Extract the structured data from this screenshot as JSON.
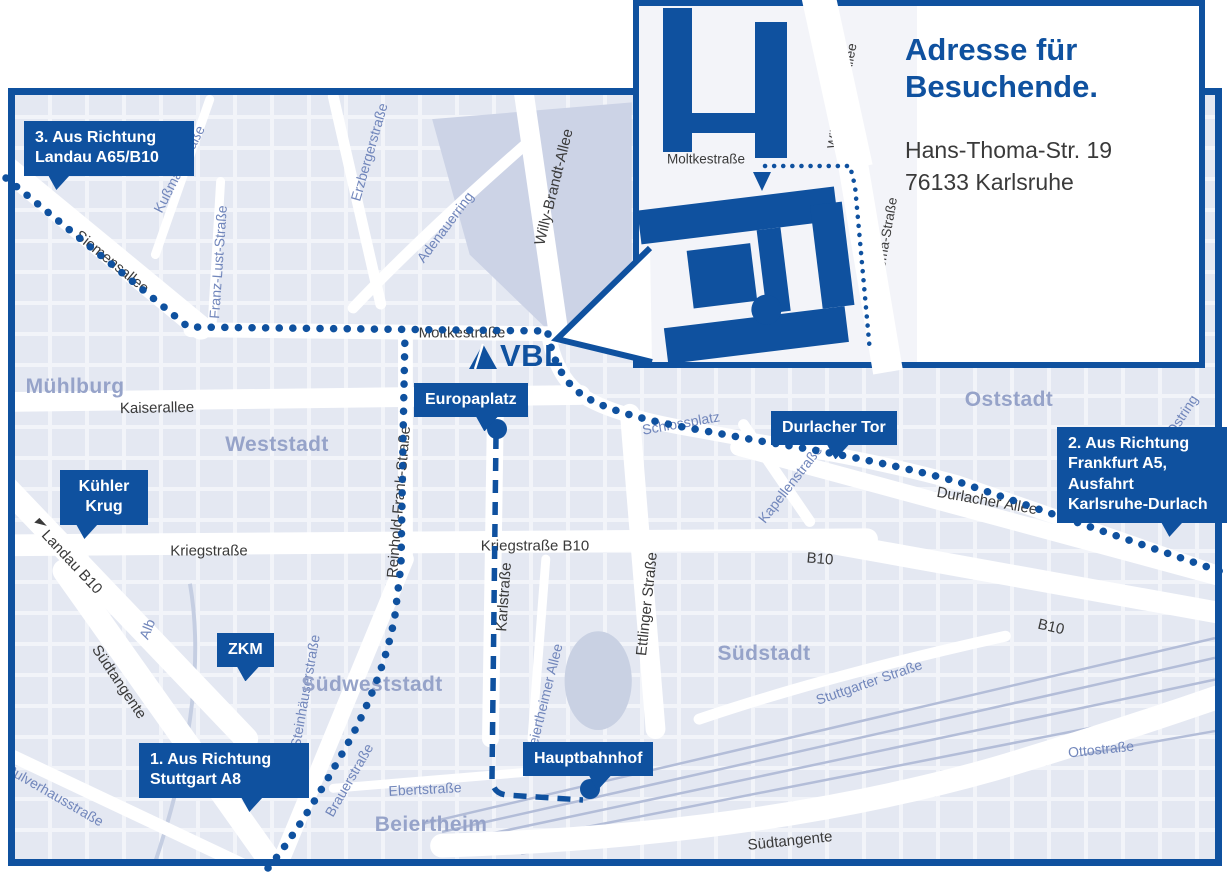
{
  "inset": {
    "title": "Adresse für\nBesuchende.",
    "address": "Hans-Thoma-Str. 19\n76133 Karlsruhe",
    "streets": {
      "moltkestrasse": "Moltkestraße",
      "willy_brandt_allee": "Willy-Brandt-Allee",
      "hans_thoma_strasse": "Hans-Thoma-Straße"
    }
  },
  "logo": {
    "text": "VBL"
  },
  "callouts": {
    "route3": "3. Aus Richtung\nLandau A65/B10",
    "route2": "2. Aus Richtung\nFrankfurt A5,\nAusfahrt\nKarlsruhe-Durlach",
    "route1": "1. Aus Richtung\nStuttgart A8",
    "kuehler_krug": "Kühler\nKrug",
    "zkm": "ZKM",
    "europaplatz": "Europaplatz",
    "durlacher_tor": "Durlacher Tor",
    "hauptbahnhof": "Hauptbahnhof"
  },
  "streets_dark": [
    "Siemensallee",
    "Moltkestraße",
    "Kaiserallee",
    "Kriegstraße",
    "Kriegstraße B10",
    "Reinhold-Frank-Straße",
    "Karlstraße",
    "Ettlinger Straße",
    "Willy-Brandt-Allee",
    "Durlacher Allee",
    "B10",
    "B10",
    "Landau B10",
    "Südtangente",
    "Südtangente"
  ],
  "streets_blue": [
    "Kußmaulstraße",
    "Franz-Lust-Straße",
    "Erzbergerstraße",
    "Adenauerring",
    "Schlossplatz",
    "Kapellenstraße",
    "Ostring",
    "Stuttgarter Straße",
    "Ottostraße",
    "Steinhäuserstraße",
    "Brauerstraße",
    "Ebertstraße",
    "Beiertheimer Allee",
    "Alb",
    "Pulverhausstraße"
  ],
  "districts": [
    "Mühlburg",
    "Weststadt",
    "Oststadt",
    "Südstadt",
    "Südweststadt",
    "Beiertheim"
  ],
  "colors": {
    "primary_blue": "#0f519f",
    "street_text_dark": "#3a3a3a",
    "street_text_blue": "#7186bb",
    "district_text": "#96a3c9",
    "map_background": "#e4e8f2"
  }
}
